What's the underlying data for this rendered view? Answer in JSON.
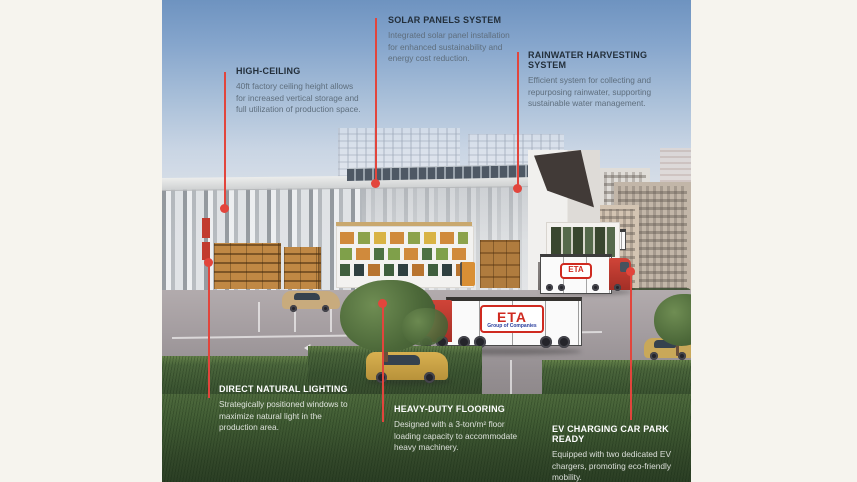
{
  "meta": {
    "background_color": "#f6f4ee",
    "accent_red": "#e2453c",
    "scene_type": "factory-warehouse-3d-render-infographic"
  },
  "callouts": [
    {
      "id": "high-ceiling",
      "title": "HIGH-CEILING",
      "description": "40ft factory ceiling height allows for increased vertical storage and full utilization of production space."
    },
    {
      "id": "solar-panels",
      "title": "SOLAR PANELS SYSTEM",
      "description": "Integrated solar panel installation for enhanced sustainability and energy cost reduction."
    },
    {
      "id": "rainwater",
      "title": "RAINWATER HARVESTING SYSTEM",
      "description": "Efficient system for collecting and repurposing rainwater, supporting sustainable water management."
    },
    {
      "id": "natural-lighting",
      "title": "DIRECT NATURAL LIGHTING",
      "description": "Strategically positioned windows to maximize natural light in the production area."
    },
    {
      "id": "flooring",
      "title": "HEAVY-DUTY FLOORING",
      "description": "Designed with a 3-ton/m² floor loading capacity to accommodate heavy machinery."
    },
    {
      "id": "ev-charging",
      "title": "EV CHARGING CAR PARK READY",
      "description": "Equipped with two dedicated EV chargers, promoting eco-friendly mobility."
    }
  ],
  "scene": {
    "truck_logo": "ETA",
    "truck_logo_subtext": "Group of Companies",
    "dock_truck_logo": "ETA"
  }
}
